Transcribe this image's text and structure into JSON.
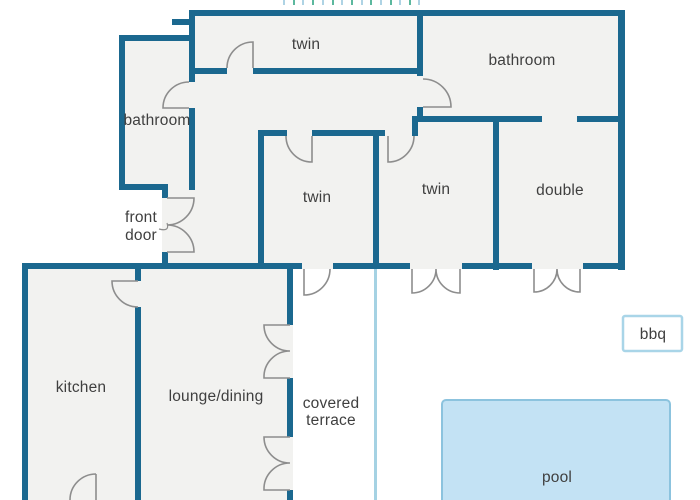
{
  "plan_title": "villa floor plan",
  "labels": {
    "twin_top": "twin",
    "bathroom_top": "bathroom",
    "bathroom_left": "bathroom",
    "front_door_line1": "front",
    "front_door_line2": "door",
    "twin_mid": "twin",
    "twin_right": "twin",
    "double": "double",
    "kitchen": "kitchen",
    "lounge_dining": "lounge/dining",
    "covered_terrace_line1": "covered",
    "covered_terrace_line2": "terrace",
    "bbq": "bbq",
    "pool": "pool"
  },
  "colors": {
    "background": "#ffffff",
    "wall": "#1b688f",
    "room": "#f2f2f0",
    "door": "#8d8d8d",
    "label": "#3f3f3f",
    "pool_fill": "#c3e2f4",
    "pool_border": "#8cc3de",
    "bbq_border": "#a9d5e8",
    "terrace_line": "#a5d2e3",
    "tick_blue": "#aed3e4",
    "tick_green": "#5cb89e"
  }
}
